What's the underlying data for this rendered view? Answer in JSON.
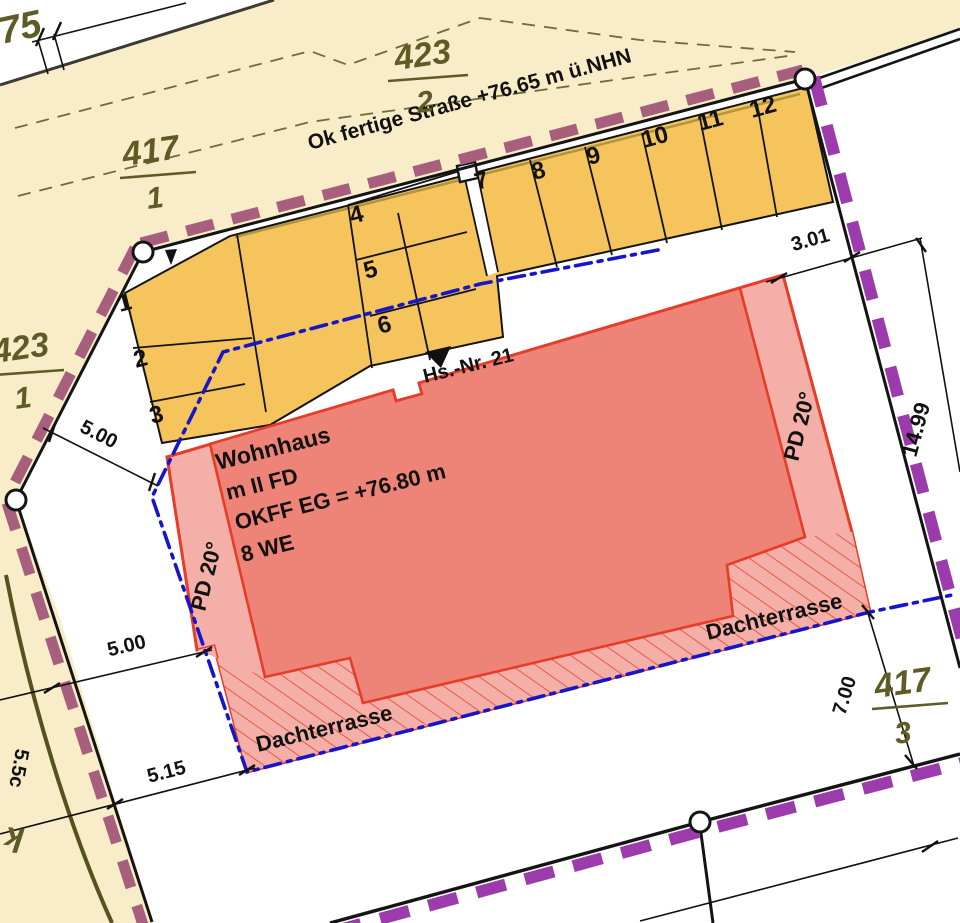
{
  "plan": {
    "street_label": "Ok fertige Straße +76.65 m ü.NHN",
    "house_number": "Hs.-Nr. 21",
    "building": {
      "line1": "Wohnhaus",
      "line2": "m II FD",
      "line3": "OKFF EG = +76.80 m",
      "line4": "8 WE"
    },
    "roof_pitch_left": "PD 20°",
    "roof_pitch_right": "PD 20°",
    "terrace_left": "Dachterrasse",
    "terrace_right": "Dachterrasse",
    "parcels": [
      {
        "num": "423",
        "den": "2"
      },
      {
        "num": "417",
        "den": "1"
      },
      {
        "num": "423",
        "den": "1"
      },
      {
        "num": "417",
        "den": "3"
      }
    ],
    "stalls": [
      "1",
      "2",
      "3",
      "4",
      "5",
      "6",
      "7",
      "8",
      "9",
      "10",
      "11",
      "12"
    ],
    "dimensions": {
      "west_upper": "5.00",
      "west_lower": "5.00",
      "southwest": "5.15",
      "northeast": "3.01",
      "east": "14.99",
      "southeast": "7.00",
      "top_left_partial": "75",
      "bottom_left_partial": "5.5c",
      "bottom_left_fragment": "k"
    },
    "colors": {
      "street_fill": "#f8edc8",
      "stall_fill": "#f5c45c",
      "building_fill": "#ee8478",
      "building_light_fill": "#f4b0a8",
      "building_stroke": "#e63c28",
      "hatch_stroke": "#e2452f",
      "boundary_black": "#141414",
      "boundary_purple_north": "#a85f7e",
      "boundary_purple_south": "#9c3bab",
      "blue_line": "#1616c8",
      "parcel_text": "#5e5b27",
      "olive_road": "#55521f",
      "cadastre_dash": "#6f6b3a"
    }
  }
}
